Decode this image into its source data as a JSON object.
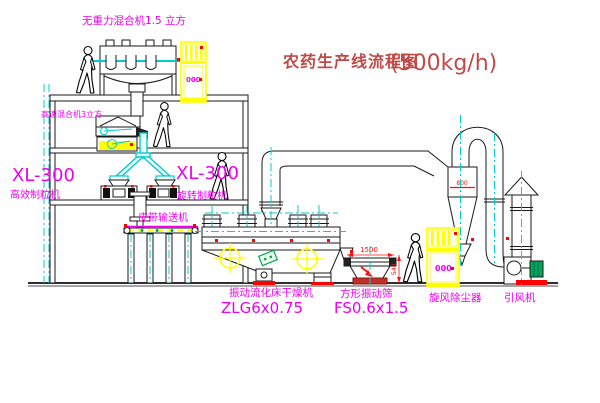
{
  "title": {
    "line": "农药生产线流程图",
    "capacity": "(500kg/h)"
  },
  "labels": {
    "top_mixer": "无重力混合机1.5 立方",
    "high_speed_mixer": "高速混合机3立方",
    "granulator_left_model": "XL-300",
    "granulator_left_name": "高效制粒机",
    "granulator_mid_model": "XL-300",
    "granulator_mid_name": "旋转制粒机",
    "belt_conveyor": "皮带输送机",
    "dryer_name": "振动流化床干燥机",
    "dryer_model": "ZLG6x0.75",
    "sieve_name": "方形振动筛",
    "sieve_model": "FS0.6x1.5",
    "cyclone_name": "旋风除尘器",
    "fan_name": "引风机"
  },
  "dimensions": {
    "sieve_width": "1500",
    "sieve_height": "541",
    "cyclone_inlet": "800"
  },
  "cabinets": {
    "display_1": "000",
    "display_2": "000"
  },
  "colors": {
    "label_magenta": "#ee00ee",
    "title_red": "#be4b48",
    "centerline_cyan": "#00cdcd",
    "cabinet_yellow": "#ffff00",
    "alert_red": "#ff0000",
    "motor_green": "#00a651",
    "linework": "#1a1a1a"
  }
}
